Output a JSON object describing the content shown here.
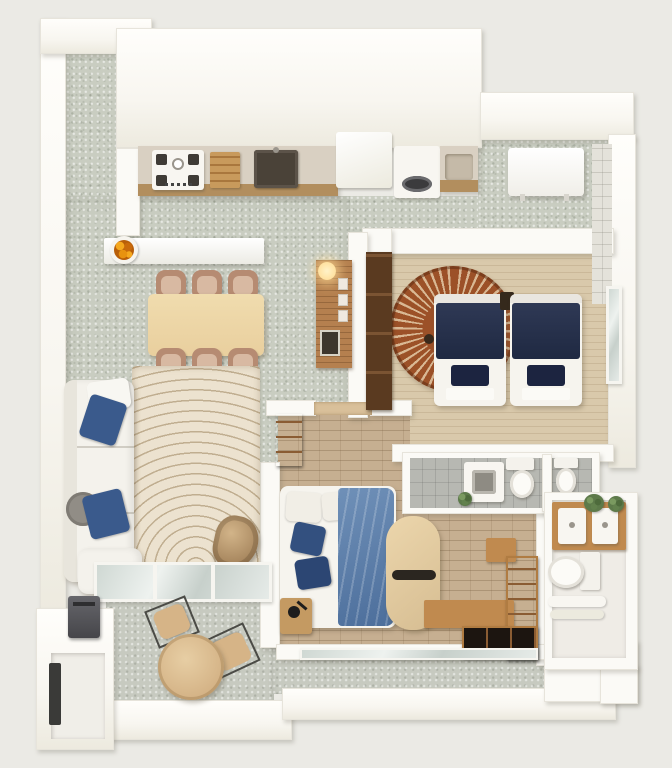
{
  "title": "3d-apartment-floor-plan-render",
  "palette": {
    "bg": "#ebeae5",
    "wall": "#fbfaf6",
    "tile": "#c9cdc1",
    "balcony": "#c7cac0",
    "woodfloor": "#d9c9ab",
    "brick": "#c6af91",
    "bathtile": "#b7b8b2",
    "counter": "#d9d0c2",
    "counterface": "#b28e5e",
    "navy": "#27304e",
    "duvetblue": "#5d80ab",
    "rugc": "#ece2cf",
    "ruga": "#c0ae90",
    "rrug": "#9c5128",
    "rrugs": "#d9b894",
    "chair": "#b68b72",
    "tablewood": "#e9cf9e",
    "slat": "#b5804f",
    "sofa": "#f4f2ec",
    "pillowblue": "#3a5a8c",
    "egg": "#bfa077",
    "darkwood": "#1c1510",
    "woodtrim": "#c08a4f",
    "plant": "#5d7a4a",
    "orange": "#e8920f",
    "glassc": "#cfd8d3",
    "dark": "#55555a"
  },
  "scene": {
    "rooms": [
      {
        "name": "entry-corridor",
        "items": []
      },
      {
        "name": "kitchen",
        "items": [
          "cooktop",
          "cutting-board",
          "sink",
          "refrigerator",
          "washing-machine",
          "counter-basin"
        ]
      },
      {
        "name": "service-area",
        "items": [
          "water-heater",
          "tiled-wall"
        ]
      },
      {
        "name": "living-dining",
        "items": [
          "breakfast-bar",
          "fruit-bowl",
          "dining-table",
          "dining-chairs-x6",
          "corner-sofa",
          "blue-cushions",
          "area-rug",
          "egg-chair",
          "slat-accent-wall",
          "wall-lamp",
          "picture-frames",
          "framed-art"
        ]
      },
      {
        "name": "twin-bedroom",
        "items": [
          "twin-bed-left",
          "twin-bed-right",
          "round-sunburst-rug",
          "tall-wardrobe",
          "nightstand",
          "window"
        ]
      },
      {
        "name": "hallway",
        "items": [
          "bookshelf",
          "door-threshold"
        ]
      },
      {
        "name": "bathroom",
        "items": [
          "vanity",
          "toilet",
          "toilet-second",
          "plant"
        ]
      },
      {
        "name": "master-bedroom",
        "items": [
          "double-bed",
          "white-pillows",
          "navy-pillows",
          "blue-duvet",
          "curved-desk",
          "dark-wardrobe",
          "wood-bench",
          "wood-box",
          "nightstand",
          "desk-lamp"
        ]
      },
      {
        "name": "wc",
        "items": [
          "wood-vanity",
          "washbasin-left",
          "washbasin-right",
          "plants",
          "toilet",
          "towels"
        ]
      },
      {
        "name": "balcony",
        "items": [
          "round-table",
          "chair-left",
          "chair-right",
          "ac-unit",
          "sliding-glass-door",
          "bedroom-glass-door"
        ]
      },
      {
        "name": "storage-nook",
        "items": [
          "dark-slot"
        ]
      }
    ]
  }
}
